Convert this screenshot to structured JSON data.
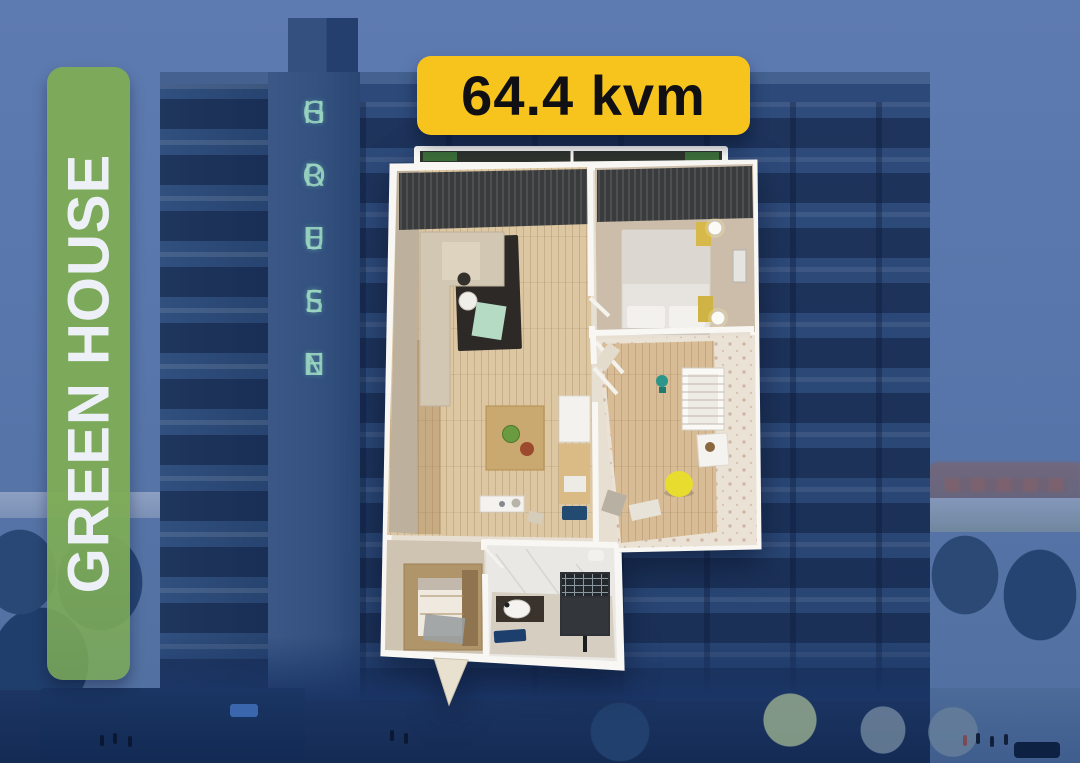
{
  "badges": {
    "brand": "GREEN HOUSE",
    "area": "64.4 kvm"
  },
  "building_sign": {
    "word1": "GREEN",
    "word2": "HOUSE"
  },
  "colors": {
    "badge_green": "#7dac57",
    "badge_yellow": "#f7c41d",
    "badge_text_dark": "#101014",
    "brand_text_white": "#edf1f7",
    "sign_letters_teal": "#9ad6c1",
    "sky_blue": "#5e7bb1",
    "building_navy": "#2c4979",
    "plan_wall_white": "#f8f7f4",
    "wood_floor": "#dcc7a2"
  },
  "floorplan": {
    "rooms": [
      "balcony",
      "living-room",
      "kitchen",
      "bedroom",
      "kids-room",
      "bathroom",
      "entry-hall"
    ]
  }
}
